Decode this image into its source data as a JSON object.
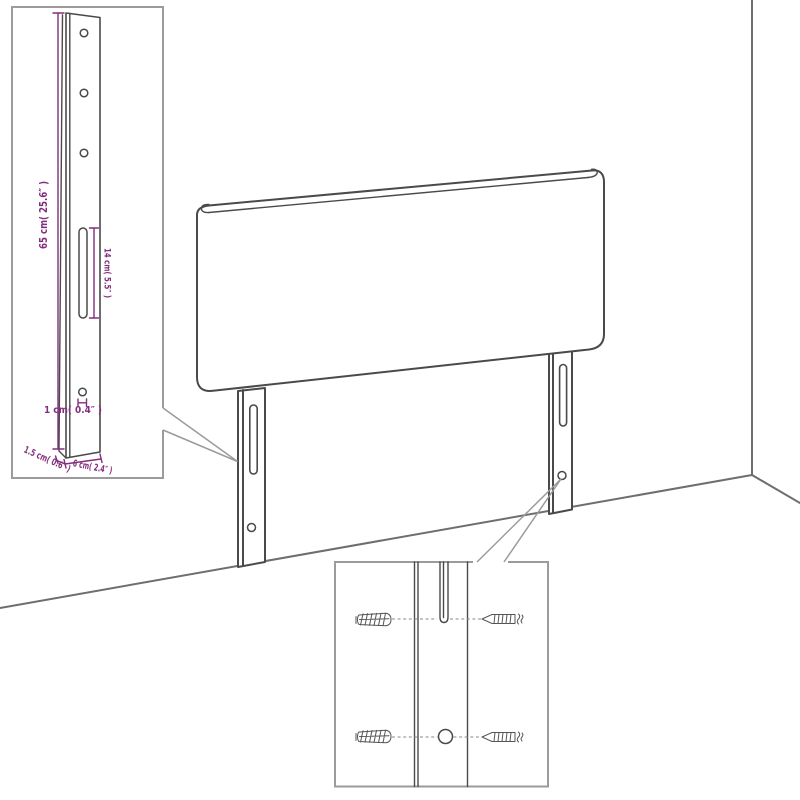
{
  "colors": {
    "background": "#ffffff",
    "product_line": "#4a4a4a",
    "wall_line": "#6e6e6e",
    "frame_line": "#9b9b9b",
    "dimension": "#822d7e"
  },
  "leg_detail_inset": {
    "height_label": "65 cm( 25.6″ )",
    "slot_label": "14 cm( 5.5″ )",
    "hole_label": "1 cm( 0.4″ )",
    "thickness_label": "1.5 cm( 0.6″ )",
    "width_label": "6 cm( 2.4″ )"
  }
}
